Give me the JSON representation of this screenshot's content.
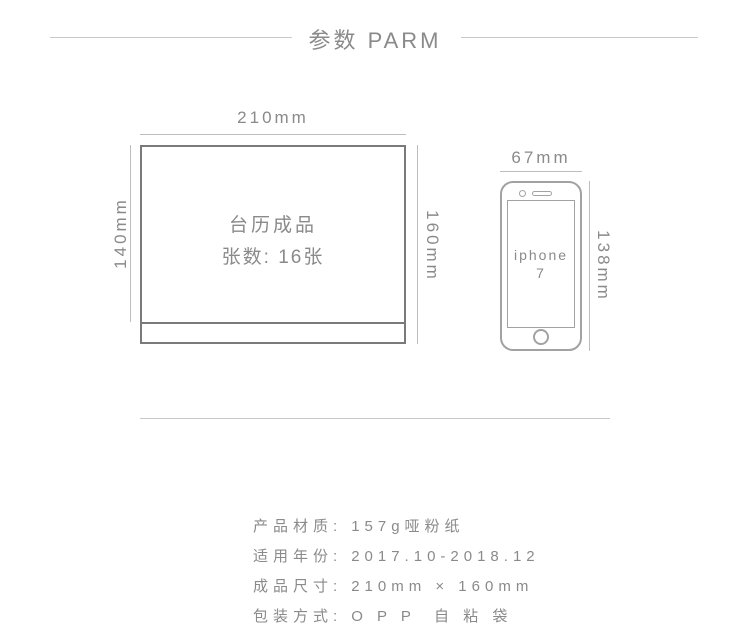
{
  "header": {
    "title": "参数 PARM"
  },
  "calendar": {
    "width_label": "210mm",
    "left_height_label": "140mm",
    "right_height_label": "160mm",
    "product_name": "台历成品",
    "sheet_count": "张数: 16张"
  },
  "phone": {
    "width_label": "67mm",
    "height_label": "138mm",
    "model_line1": "iphone",
    "model_line2": "7"
  },
  "specs": {
    "rows": [
      {
        "label": "产品材质:",
        "value": "157g哑粉纸"
      },
      {
        "label": "适用年份:",
        "value": "2017.10-2018.12"
      },
      {
        "label": "成品尺寸:",
        "value": "210mm × 160mm"
      },
      {
        "label": "包装方式:",
        "value": "O P P  自 粘 袋"
      }
    ]
  },
  "colors": {
    "text": "#8a8a8a",
    "calendar_border": "#7a7a7a",
    "phone_border": "#a2a2a2",
    "dim_line": "#bdbdbd",
    "header_line": "#c9c9c9",
    "divider": "#c8c8c8",
    "bg": "#ffffff"
  }
}
